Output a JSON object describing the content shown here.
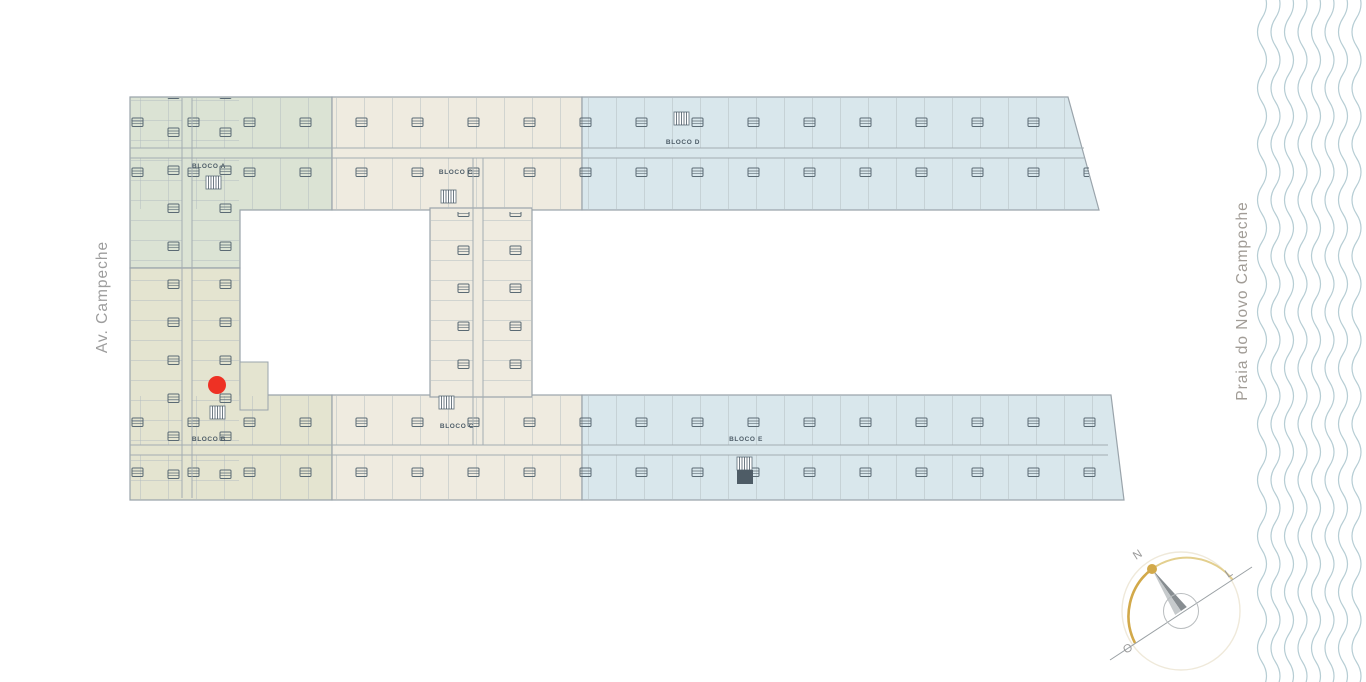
{
  "map": {
    "street_label": "Av. Campeche",
    "beach_label": "Praia do Novo Campeche"
  },
  "blocks": {
    "a": {
      "label": "BLOCO A",
      "color": "#dbe3d4"
    },
    "b": {
      "label": "BLOCO B",
      "color": "#e4e4d0"
    },
    "c": {
      "label": "BLOCO C",
      "color": "#efebe0"
    },
    "d": {
      "label": "BLOCO D",
      "color": "#d9e7ec"
    },
    "e": {
      "label": "BLOCO E",
      "color": "#d9e7ec"
    }
  },
  "marker": {
    "color": "#ee3124"
  },
  "compass": {
    "north": "N",
    "east": "L",
    "west": "O",
    "accent": "#d2a94a"
  },
  "waves": {
    "color": "#b6cdd4"
  }
}
